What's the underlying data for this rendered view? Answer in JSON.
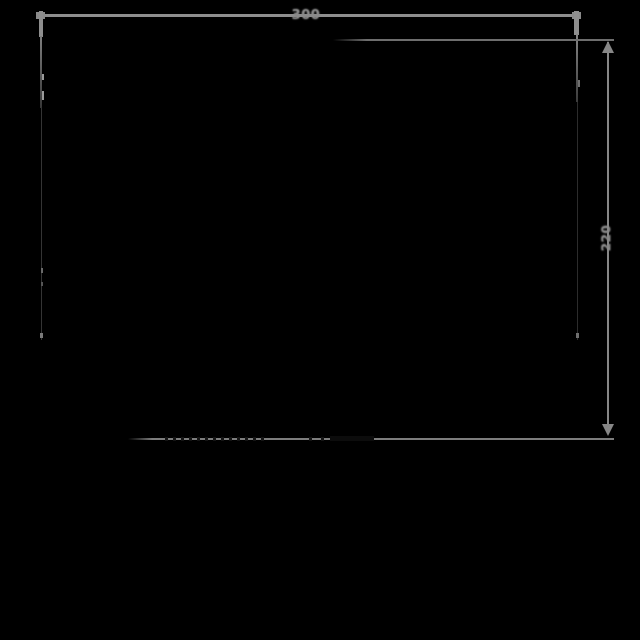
{
  "drawing": {
    "type": "technical-dimension-drawing",
    "width_dimension": {
      "label": "300"
    },
    "height_dimension": {
      "label": "220"
    },
    "colors": {
      "background": "#000000",
      "dimension_line": "#8e8e8e",
      "extension_line": "#6e6e6e",
      "bottom_extension_line": "#7d7d7d",
      "faint_object_edge": "#343434",
      "label_text": "#8b8b8b"
    }
  }
}
